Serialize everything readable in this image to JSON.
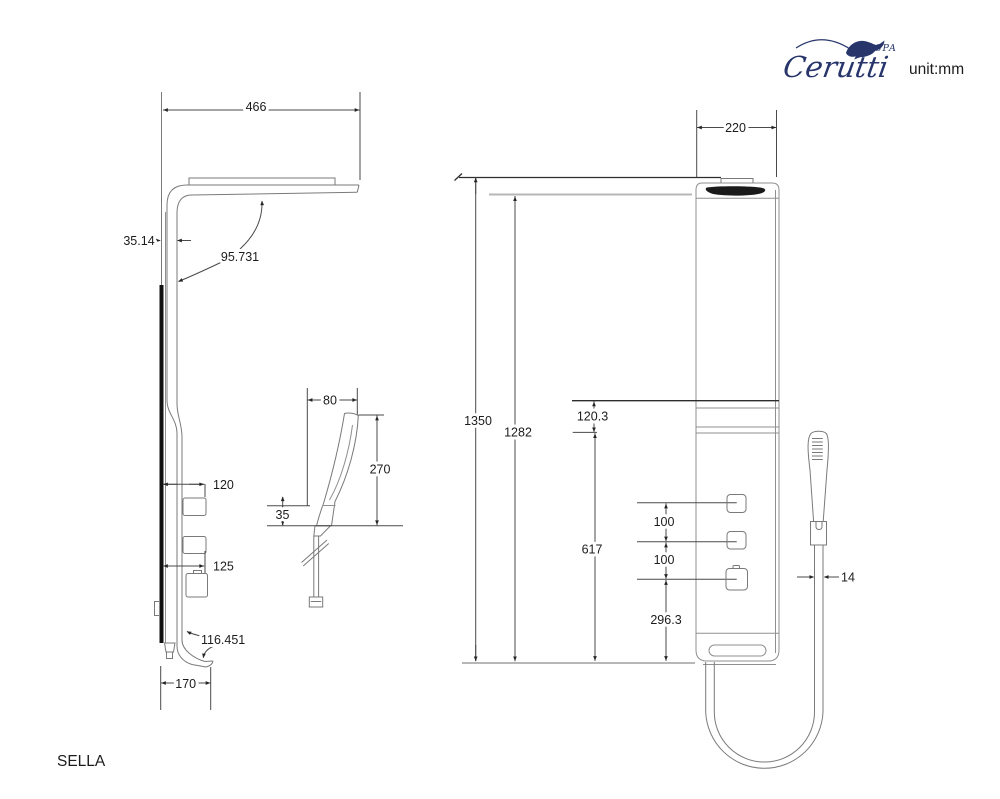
{
  "header": {
    "brand": "Cerutti",
    "brand_sub": "SPA",
    "unit": "unit:mm"
  },
  "model": "SELLA",
  "side": {
    "top_width": "466",
    "panel_thickness": "35.14",
    "arm_angle": "95.731",
    "control_offset": "120",
    "control_offset_lower": "125",
    "foot_curve": "116.451",
    "base_depth": "170"
  },
  "hand": {
    "head_width": "80",
    "height": "270",
    "bracket_height": "35"
  },
  "front": {
    "width": "220",
    "total_height": "1350",
    "body_height": "1282",
    "head_section": "120.3",
    "control_section": "617",
    "knob_spacing_1": "100",
    "knob_spacing_2": "100",
    "bottom_section": "296.3",
    "hose_diameter": "14"
  },
  "colors": {
    "outline": "#8f8f8f",
    "dimension": "#4a4a4a",
    "brand": "#27356b",
    "lens": "#1a1a1a"
  }
}
